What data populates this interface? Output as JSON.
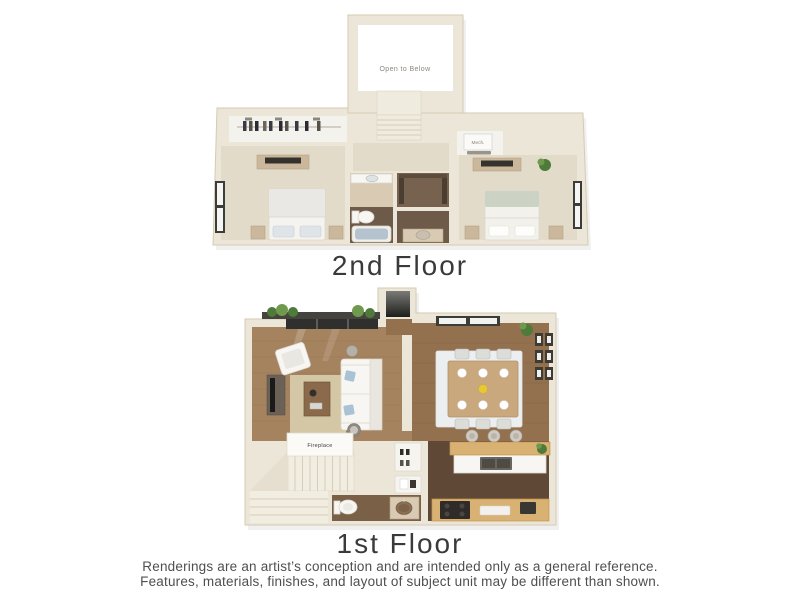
{
  "labels": {
    "floor2": "2nd Floor",
    "floor1": "1st Floor",
    "open_to_below": "Open to Below",
    "mech": "Mech.",
    "fireplace": "Fireplace"
  },
  "disclaimer": {
    "line1": "Renderings are an artist’s conception and are intended only as a general reference.",
    "line2": "Features, materials, finishes, and layout of subject unit may be different than shown."
  },
  "colors": {
    "background": "#ffffff",
    "wall": "#ece6d8",
    "wall_shade": "#d6cab2",
    "carpet": "#e3dbca",
    "bath_floor_dark": "#6d5a48",
    "bath_floor_tan": "#d8cab3",
    "wood_living": "#a5835f",
    "wood_dining": "#93714f",
    "wood_kitchen": "#5f4936",
    "rug_living": "#d3c7a5",
    "rug_dining": "#eceff0",
    "counter_wood": "#d9b173",
    "furniture_white": "#f7f6f3",
    "pillow_blue": "#a9c3d4",
    "tub_water": "#b4c3cd",
    "plant_green": "#4e7a3a",
    "window_frame": "#3c3c38",
    "heading_text": "#3a3a3a",
    "note_text": "#4f4f4f",
    "plan_label_text": "#8d887c"
  }
}
